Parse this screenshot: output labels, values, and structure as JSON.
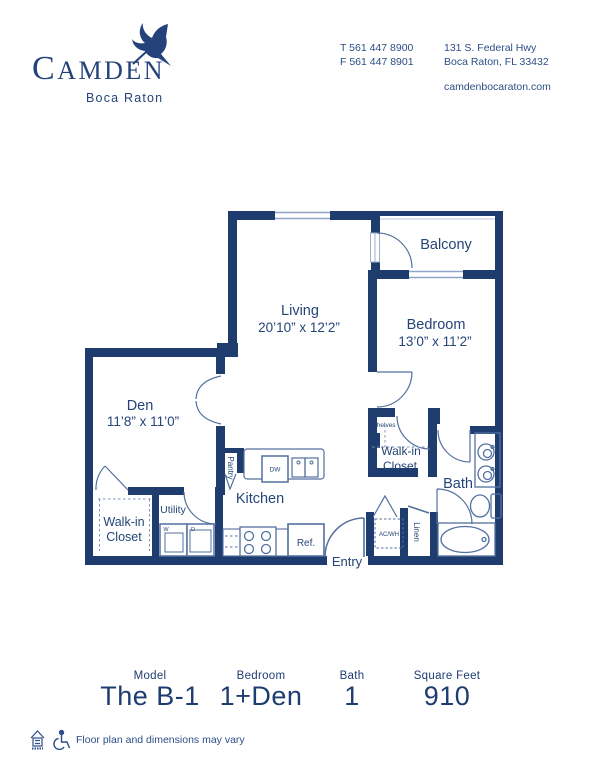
{
  "colors": {
    "wall_navy": "#1e3c6e",
    "fixture_blue": "#53709f",
    "light_blue": "#9fb0cc",
    "text_navy": "#254578"
  },
  "header": {
    "brand_initial": "C",
    "brand_rest": "AMDEN",
    "brand_sub": "Boca Raton",
    "phone_line1": "T 561 447 8900",
    "phone_line2": "F 561 447 8901",
    "address_line1": "131 S. Federal Hwy",
    "address_line2": "Boca Raton, FL 33432",
    "website": "camdenbocaraton.com"
  },
  "plan": {
    "balcony": "Balcony",
    "living_name": "Living",
    "living_dims": "20’10” x 12’2”",
    "bedroom_name": "Bedroom",
    "bedroom_dims": "13’0” x 11’2”",
    "den_name": "Den",
    "den_dims": "11’8” x 11’0”",
    "kitchen": "Kitchen",
    "bath": "Bath",
    "utility": "Utility",
    "walkin1_line1": "Walk-in",
    "walkin1_line2": "Closet",
    "walkin2_line1": "Walk-in",
    "walkin2_line2": "Closet",
    "shelves1": "Shelves",
    "shelves2": "Shelves",
    "pantry": "Pantry",
    "linen": "Linen",
    "entry": "Entry",
    "acwh": "AC/WH",
    "dw": "DW",
    "ref": "Ref.",
    "washer": "W",
    "dryer": "D"
  },
  "summary": {
    "columns": [
      {
        "label": "Model",
        "value": "The B-1"
      },
      {
        "label": "Bedroom",
        "value": "1+Den"
      },
      {
        "label": "Bath",
        "value": "1"
      },
      {
        "label": "Square Feet",
        "value": "910"
      }
    ]
  },
  "disclaimer": "Floor plan and dimensions may vary"
}
